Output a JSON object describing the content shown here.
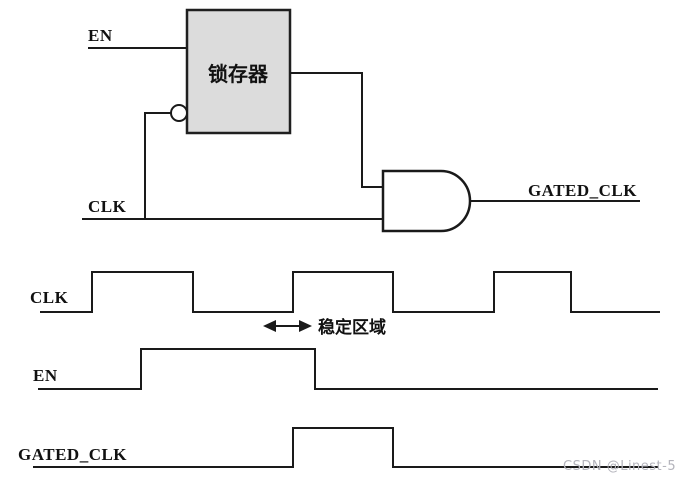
{
  "page": {
    "background": "#ffffff",
    "line_color": "#1a1a1a"
  },
  "circuit": {
    "en_label": "EN",
    "clk_label": "CLK",
    "latch_label": "锁存器",
    "latch_fill": "#dcdcdc",
    "gated_clk_label": "GATED_CLK"
  },
  "timing": {
    "clk": {
      "label": "CLK",
      "points": "40,312 92,312 92,272 193,272 193,312 293,312 293,272 393,272 393,312 494,312 494,272 571,272 571,312 660,312"
    },
    "en": {
      "label": "EN",
      "points": "38,389 141,389 141,349 315,349 315,389 658,389"
    },
    "gated_clk": {
      "label": "GATED_CLK",
      "points": "33,467 293,467 293,428 393,428 393,467 658,467"
    },
    "stable_region": {
      "label": "稳定区域"
    }
  },
  "watermark": {
    "text": "CSDN @Linest-5",
    "color": "#b4b4bc"
  }
}
